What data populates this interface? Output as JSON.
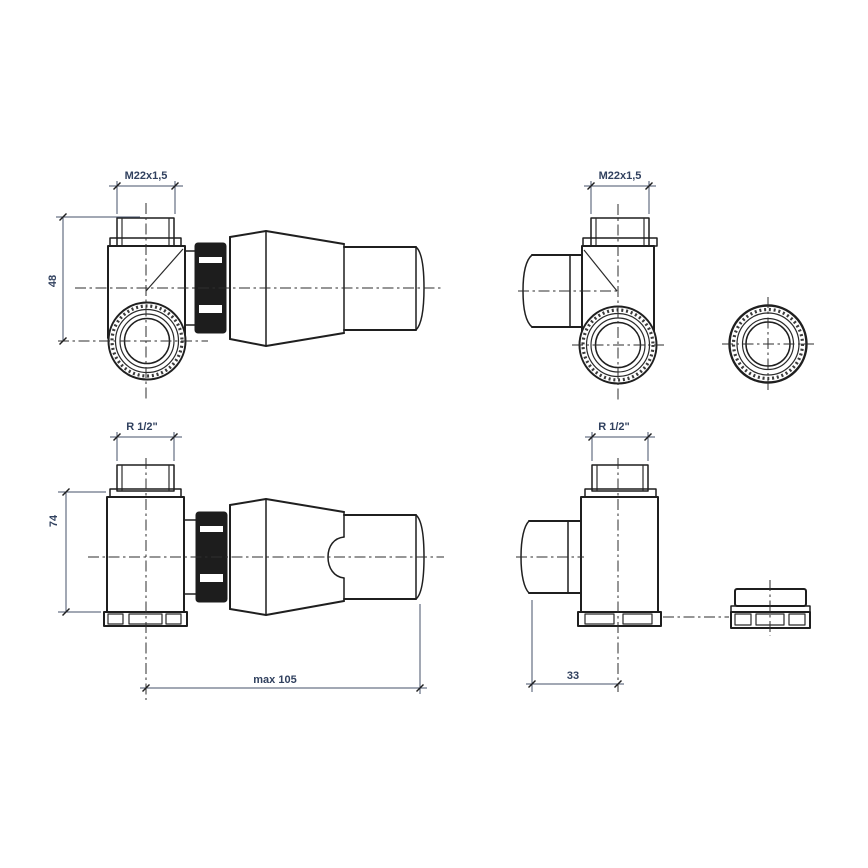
{
  "page": {
    "background": "#ffffff"
  },
  "drawing": {
    "type": "technical-drawing",
    "subject": "thermostatic radiator corner valve set, four orthographic views with ring nut part",
    "line_color": "#1f1f1f",
    "dim_text_color": "#31415f",
    "labels": {
      "thread_top_left": "M22x1,5",
      "thread_top_right": "M22x1,5",
      "thread_bottom_left": "R 1/2\"",
      "thread_bottom_right": "R 1/2\"",
      "height_axis": "48",
      "height_body": "74",
      "length_max": "max 105",
      "depth_body": "33"
    }
  }
}
